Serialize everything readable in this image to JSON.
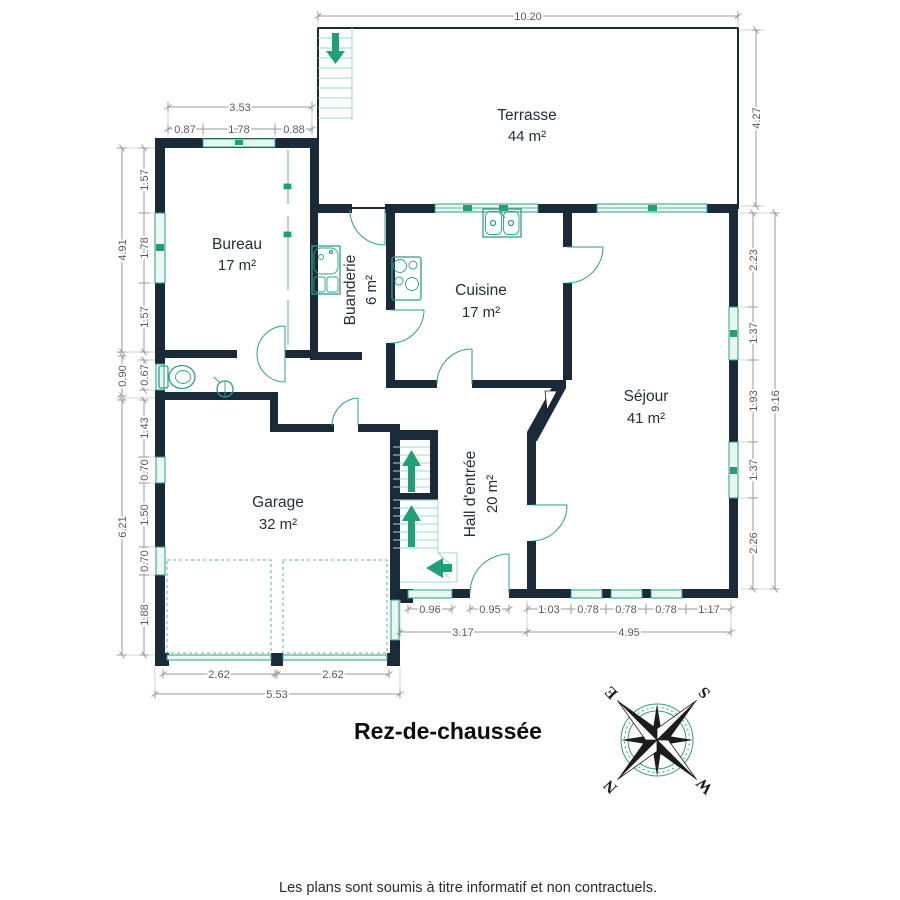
{
  "plan": {
    "floor_title": "Rez-de-chaussée",
    "disclaimer": "Les plans sont soumis à titre informatif et non contractuels.",
    "rooms": [
      {
        "name": "Terrasse",
        "area": "44 m²"
      },
      {
        "name": "Bureau",
        "area": "17 m²"
      },
      {
        "name": "Buanderie",
        "area": "6 m²"
      },
      {
        "name": "Cuisine",
        "area": "17 m²"
      },
      {
        "name": "Séjour",
        "area": "41 m²"
      },
      {
        "name": "Hall d'entrée",
        "area": "20 m²"
      },
      {
        "name": "Garage",
        "area": "32 m²"
      }
    ],
    "dims": {
      "terrasse_width": "10.20",
      "terrasse_depth": "4.27",
      "bureau_width_total": "3.53",
      "bureau_top": [
        "0.87",
        "1.78",
        "0.88"
      ],
      "left_upper_total": "4.91",
      "left_upper": [
        "1.57",
        "1.78",
        "1.57"
      ],
      "wc_depth_total": "0.90",
      "wc_window": "0.67",
      "left_lower_total": "6.21",
      "left_lower": [
        "1.43",
        "0.70",
        "1.50",
        "0.70",
        "1.88"
      ],
      "right_total": "9.16",
      "right": [
        "2.23",
        "1.37",
        "1.93",
        "1.37",
        "2.26"
      ],
      "hall_bottom": [
        "0.96",
        "0.95"
      ],
      "hall_bottom_total": "3.17",
      "sejour_bottom": [
        "1.03",
        "0.78",
        "0.78",
        "0.78",
        "1.17"
      ],
      "sejour_bottom_total": "4.95",
      "garage_doors": [
        "2.62",
        "2.62"
      ],
      "garage_width_total": "5.53"
    },
    "compass": {
      "n": "N",
      "e": "E",
      "s": "S",
      "w": "W"
    },
    "colors": {
      "wall": "#1b2a38",
      "fixture": "#2f9e85",
      "glass": "#e9f7f2",
      "arrow": "#21a077",
      "dim": "#9a9a9a",
      "dimtext": "#5a5a5a",
      "label": "#22303c"
    }
  }
}
